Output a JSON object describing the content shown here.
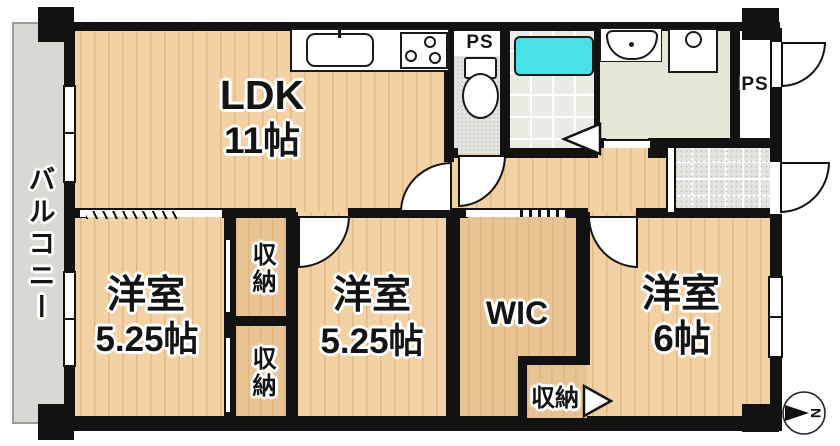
{
  "plan_title": "apartment-floorplan",
  "labels": {
    "balcony": "バルコニー",
    "ldk": {
      "name": "LDK",
      "size": "11帖"
    },
    "bedroom_left": {
      "name": "洋室",
      "size": "5.25帖"
    },
    "bedroom_middle": {
      "name": "洋室",
      "size": "5.25帖"
    },
    "bedroom_right": {
      "name": "洋室",
      "size": "6帖"
    },
    "wic": "WIC",
    "storage_top": "収納",
    "storage_bottom": "収納",
    "storage_right": "収納",
    "ps_toilet": "PS",
    "ps_entry": "PS"
  },
  "compass": {
    "north": "N"
  },
  "colors": {
    "wall": "#121212",
    "wood_floor": "#f2d1a4",
    "closet_floor": "#e9c493",
    "balcony_floor": "#d9d9d4",
    "bathtub": "#49e0e6",
    "bathroom_floor": "#e9ece2",
    "washroom_floor": "#e2e7d6",
    "toilet_floor": "#e3e3e0",
    "entry_tile": "#e4e4e1"
  }
}
